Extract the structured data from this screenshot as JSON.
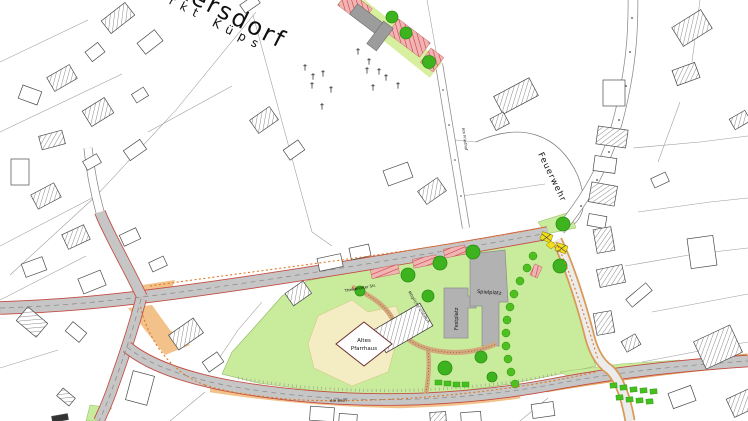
{
  "map": {
    "title_labels": {
      "village": "Burkersdorf",
      "municipality": "Markt Küps"
    },
    "area_labels": {
      "fire_station": "Feuerwehr",
      "festival_ground": "Festplatz",
      "playground": "Spielplatz",
      "old_rectory_line1": "Altes",
      "old_rectory_line2": "Pfarrhaus",
      "possible_access": "Mögliche Zufahrt"
    },
    "street_labels": {
      "main_road": "Theisenorter Str.",
      "am_bach": "Am Bach",
      "cemetery_road": "Am Friedhof"
    },
    "symbols": {
      "grave_cross": "†"
    },
    "colors": {
      "road_fill": "#c6c6c6",
      "road_edge": "#c34a42",
      "traffic_area_orange": "#f2c28a",
      "green_space": "#c9eb9c",
      "tree_green": "#3db41f",
      "hedge_green": "#4fc020",
      "parking_stall_pink": "#f0b4b4",
      "parking_stall_stripe": "#cc3333",
      "plaza_gray": "#b2b2b2",
      "courtyard_yellow": "#f4edc3",
      "path_tan": "#d2a87c",
      "boundary_orange": "#e07820",
      "signal_yellow": "#f2df1c"
    }
  }
}
